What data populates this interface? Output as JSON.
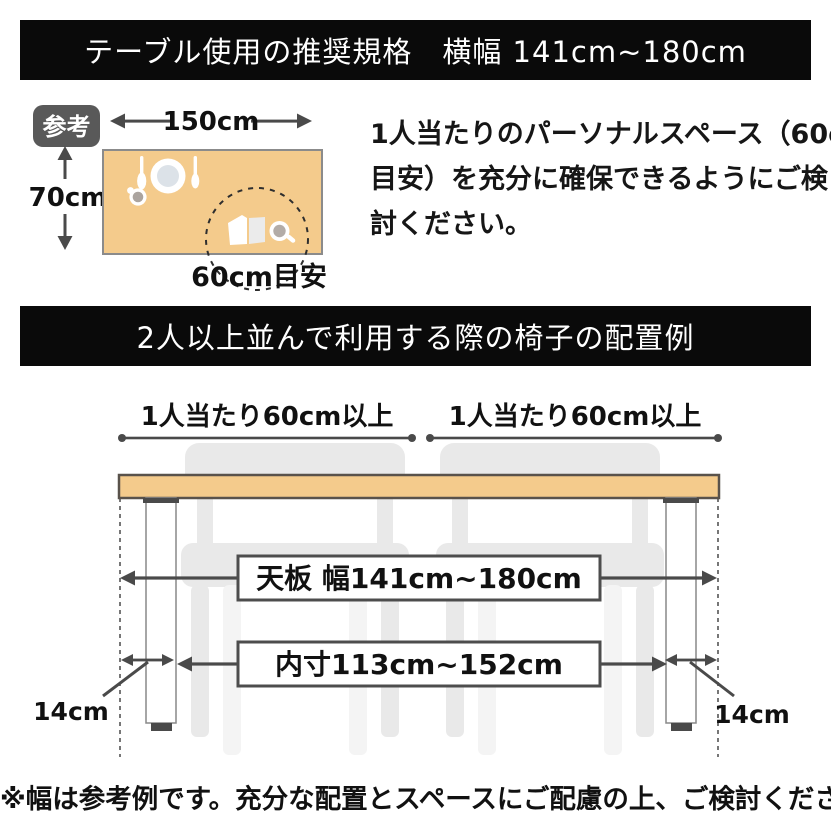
{
  "colors": {
    "banner_bg": "#0a0a0a",
    "banner_text": "#ffffff",
    "tabletop_fill": "#f4cb8c",
    "tabletop_border": "#59524b",
    "badge_bg": "#595959",
    "chair_gray": "#e9e9e9",
    "chair_light_gray": "#f4f4f4",
    "dimension_gray": "#4a4a4a",
    "text": "#111111"
  },
  "header": {
    "title": "テーブル使用の推奨規格　横幅 141cm~180cm"
  },
  "reference": {
    "badge_label": "参考",
    "table_width_label": "150cm",
    "table_depth_label": "70cm",
    "personal_space_label": "60cm目安",
    "note_lines": [
      "1人当たりのパーソナルスペース（60cm",
      "目安）を充分に確保できるようにご検",
      "討ください。"
    ]
  },
  "section2": {
    "title": "2人以上並んで利用する際の椅子の配置例"
  },
  "diagram": {
    "per_person_left_label": "1人当たり60cm以上",
    "per_person_right_label": "1人当たり60cm以上",
    "tabletop_width_label": "天板 幅141cm~180cm",
    "inner_width_label": "内寸113cm~152cm",
    "leg_inset_left_label": "14cm",
    "leg_inset_right_label": "14cm"
  },
  "footer": {
    "note": "※幅は参考例です。充分な配置とスペースにご配慮の上、ご検討ください。"
  }
}
